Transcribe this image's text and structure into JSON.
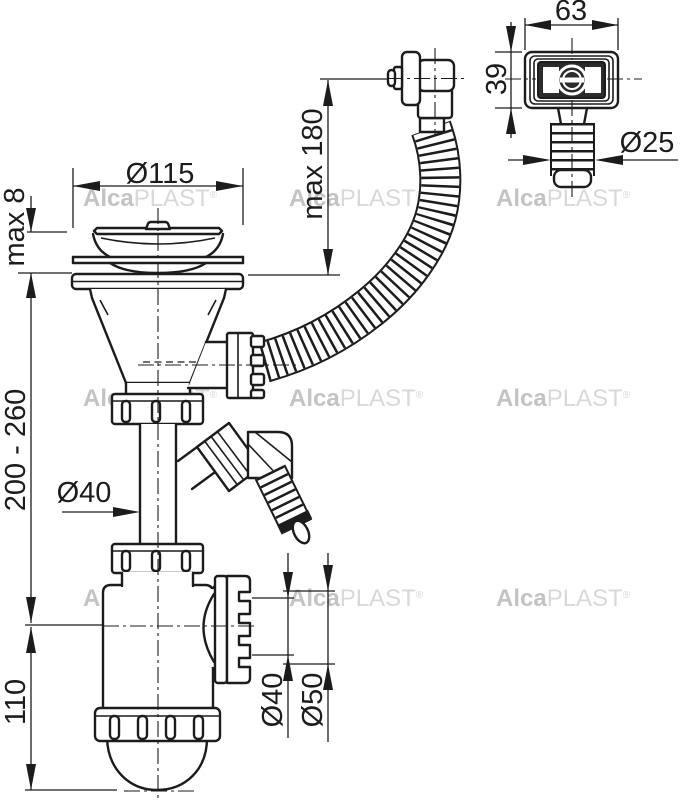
{
  "labels": {
    "max8": "max 8",
    "dia115": "Ø115",
    "max180": "max 180",
    "range": "200 - 260",
    "pipe_dia40": "Ø40",
    "height110": "110",
    "outlet_dia40": "Ø40",
    "outlet_dia50": "Ø50",
    "detail_width": "63",
    "detail_height": "39",
    "detail_dia25": "Ø25"
  },
  "watermark": {
    "bold": "Alca",
    "light": "PLAST",
    "reg": "®"
  },
  "colors": {
    "line": "#1c1c1c",
    "watermark_bold": "#c3c3c3",
    "watermark_light": "#d8d8d8",
    "background": "#ffffff"
  }
}
